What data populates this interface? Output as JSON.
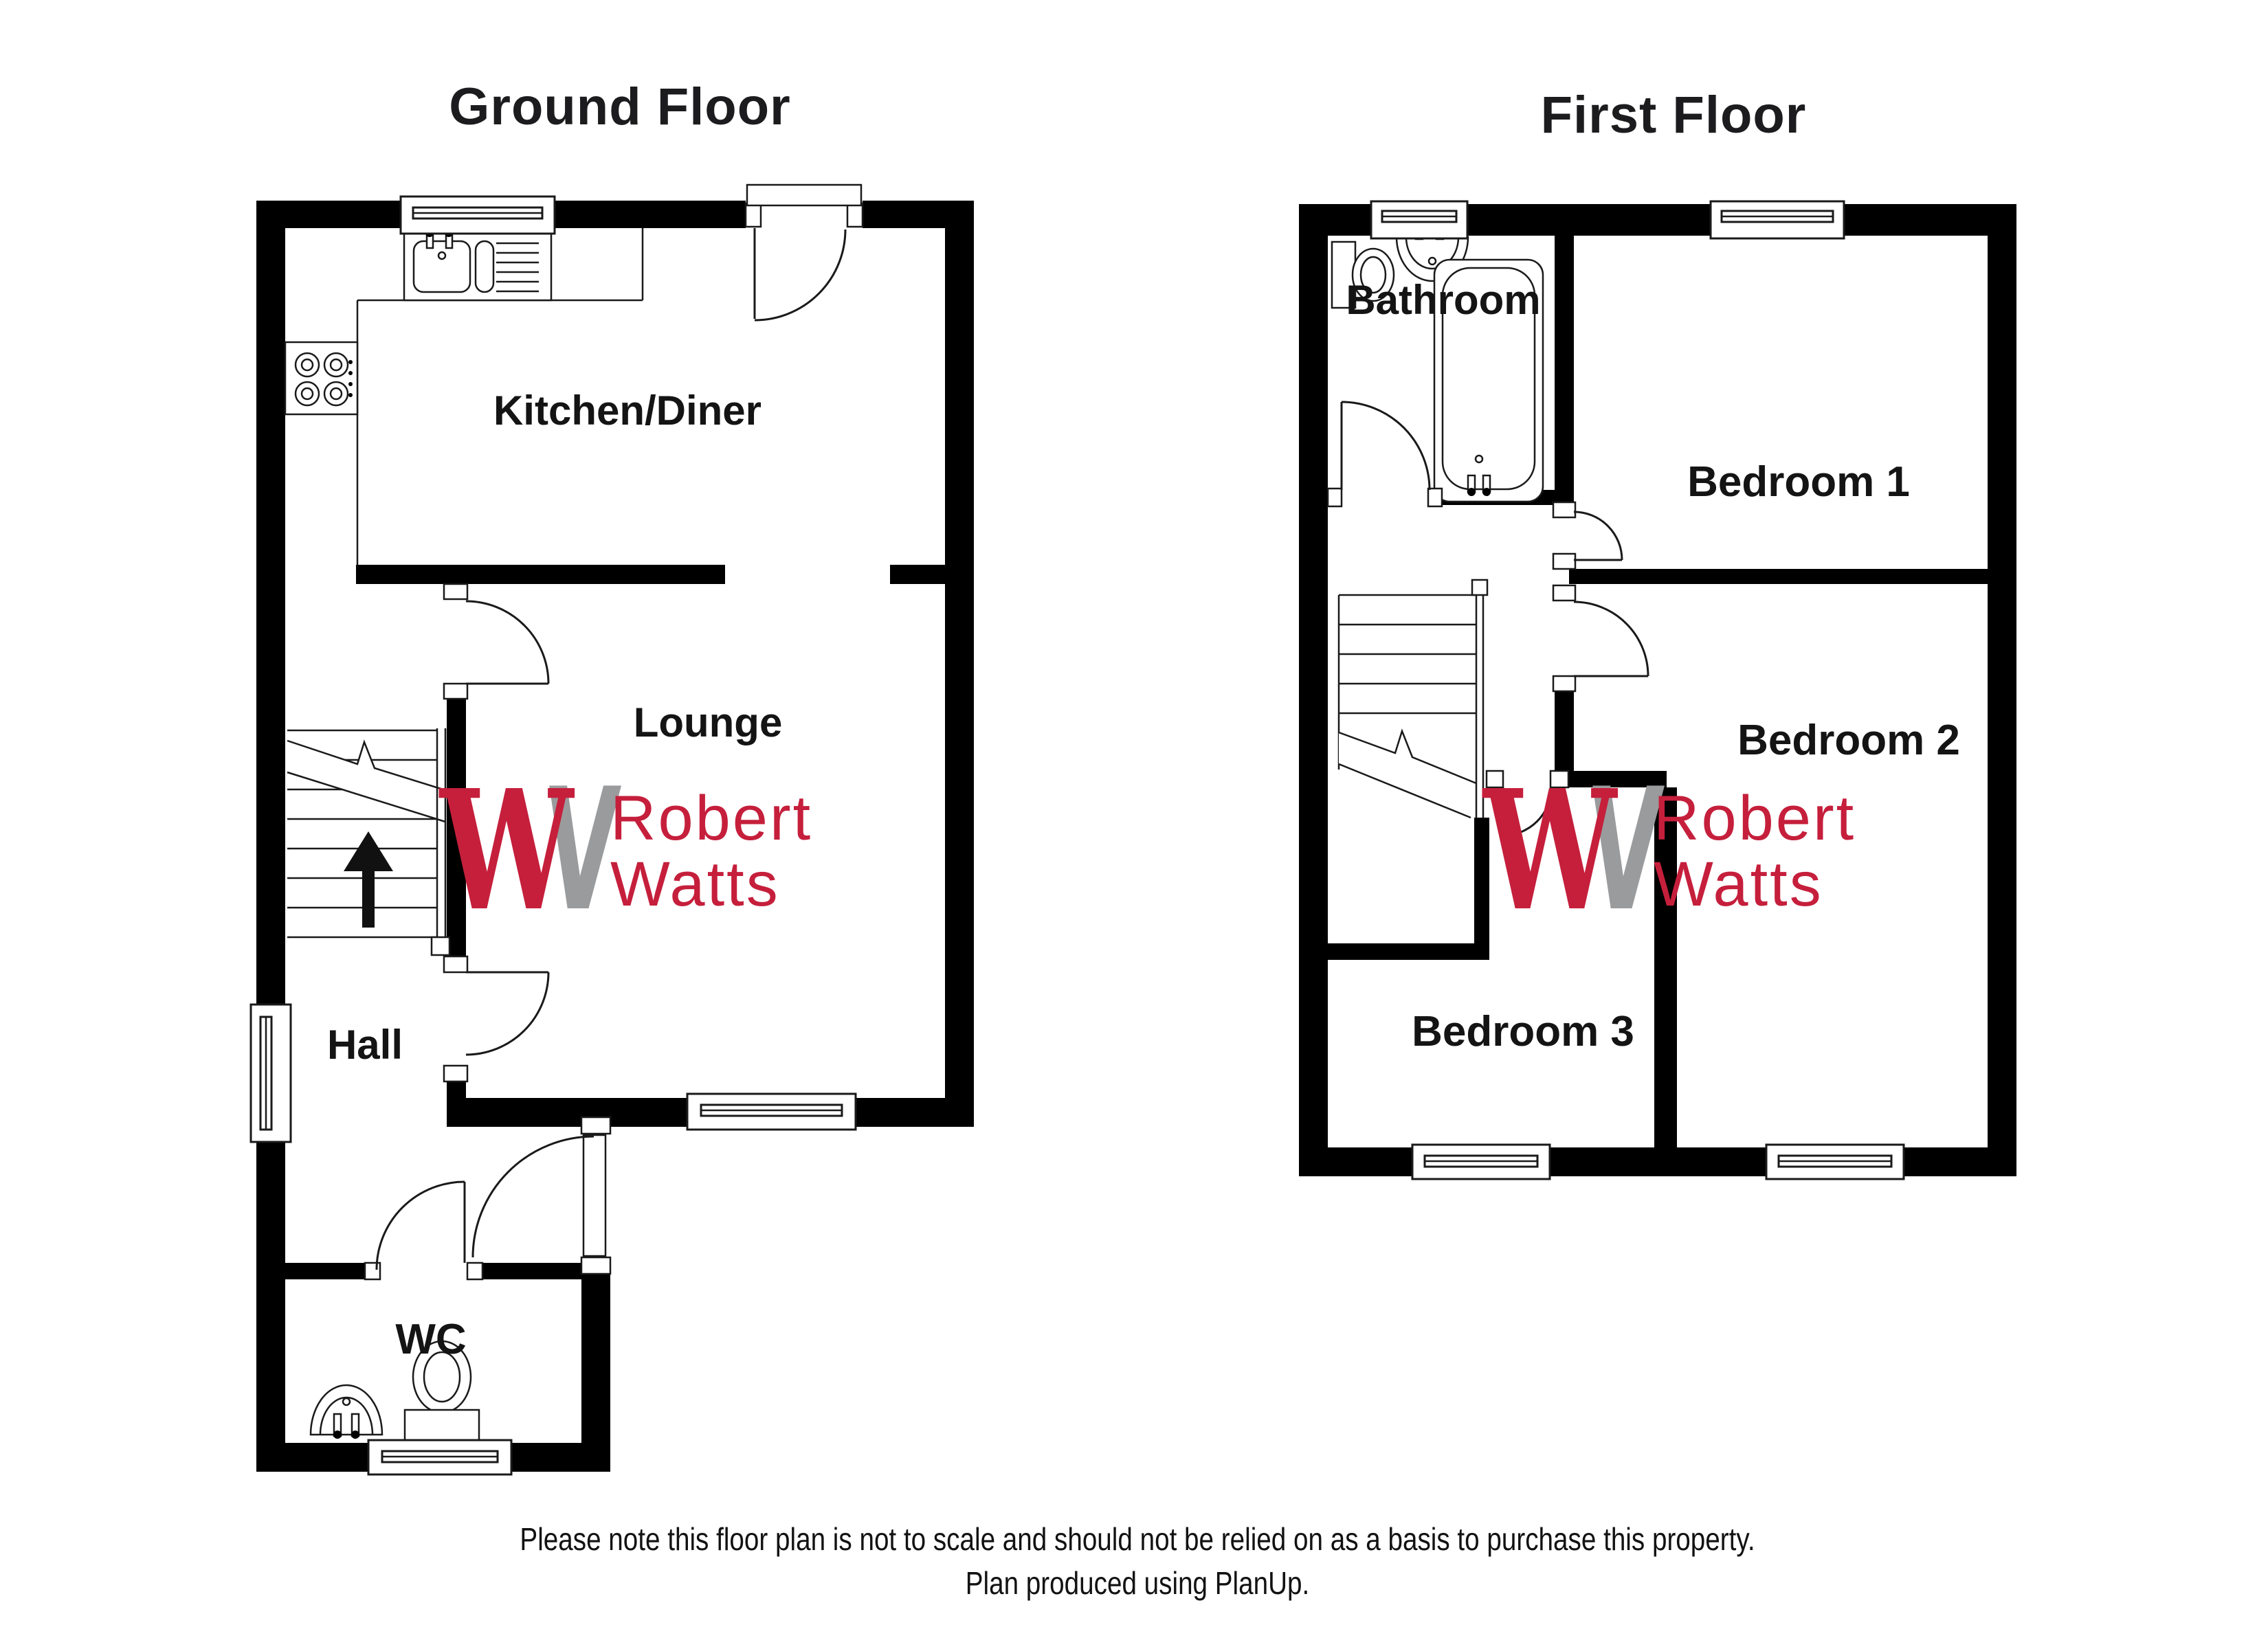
{
  "titles": {
    "ground": "Ground Floor",
    "first": "First Floor"
  },
  "ground_floor": {
    "rooms": {
      "kitchen": "Kitchen/Diner",
      "lounge": "Lounge",
      "hall": "Hall",
      "wc": "WC"
    }
  },
  "first_floor": {
    "rooms": {
      "bathroom": "Bathroom",
      "bedroom1": "Bedroom 1",
      "bedroom2": "Bedroom 2",
      "bedroom3": "Bedroom 3"
    }
  },
  "logo": {
    "monogram_primary": "W",
    "monogram_secondary": "V",
    "name_line1": "Robert",
    "name_line2": "Watts",
    "red": "#c51f3c",
    "gray": "#9a9b9d"
  },
  "footer": {
    "line1": "Please note this floor plan is not to scale and should not be relied on as a basis to purchase this property.",
    "line2": "Plan produced using PlanUp."
  }
}
